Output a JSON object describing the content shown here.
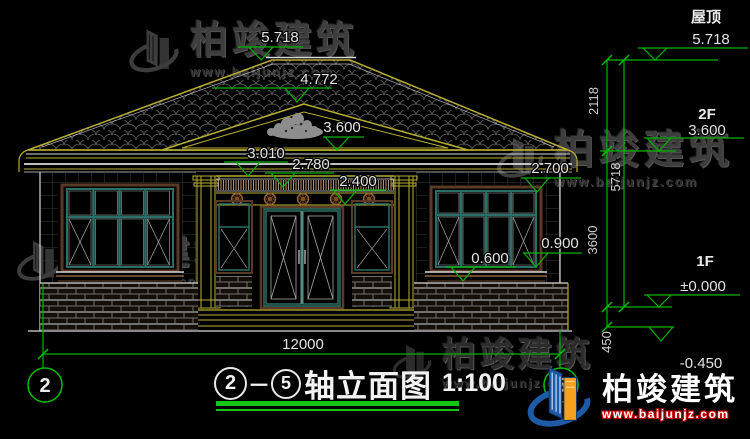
{
  "title_block": {
    "axis_start": "2",
    "dash": "－",
    "axis_end": "5",
    "name": "轴立面图",
    "scale": "1:100"
  },
  "axis_bubbles": {
    "left": "2",
    "right": "5"
  },
  "overall_dim": "12000",
  "vertical_dims": {
    "d2118": "2118",
    "d5718": "5718",
    "d3600": "3600",
    "d450": "450"
  },
  "floor_levels": {
    "roof_label": "屋顶",
    "roof": "5.718",
    "f2_label": "2F",
    "f2": "3.600",
    "f1_label": "1F",
    "f1": "±0.000",
    "base": "-0.450"
  },
  "elevation_marks": {
    "m5718": "5.718",
    "m4772": "4.772",
    "m3600": "3.600",
    "m3010": "3.010",
    "m2780": "2.780",
    "m2400": "2.400",
    "m2700": "2.700",
    "m0900": "0.900",
    "m0600": "0.600"
  },
  "watermark": {
    "brand": "柏竣建筑",
    "url": "www.baijunjz.com"
  },
  "colors": {
    "dim_green": "#00b400",
    "cad_yellow": "#b8ae33",
    "line_white": "#d9d9d9",
    "window_teal": "#2a6f66",
    "frame_brown": "#5a3a26",
    "logo_blue": "#1d5ba6",
    "logo_orange": "#f5a01e",
    "url_red": "#cc2020"
  }
}
